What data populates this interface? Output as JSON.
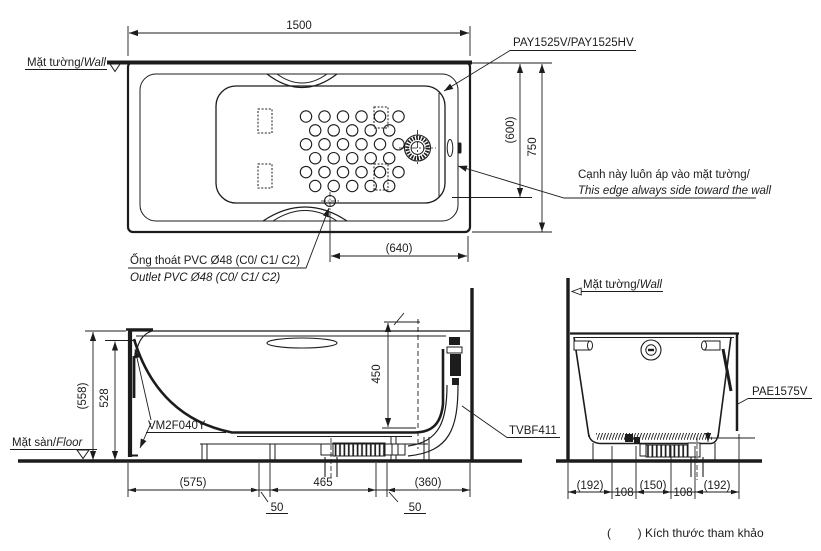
{
  "colors": {
    "ink": "#1c1c1c",
    "paper": "#ffffff"
  },
  "top_view": {
    "wall_label_vi": "Mặt tường/",
    "wall_label_en": "Wall",
    "dim_width": "1500",
    "model_label": "PAY1525V/PAY1525HV",
    "dim_inner": "(600)",
    "dim_overall": "750",
    "dim_outlet_offset": "(640)",
    "edge_note_vi": "Cạnh này luôn áp vào mặt tường/",
    "edge_note_en": "This edge always side toward the wall",
    "outlet_label_vi": "Ống thoát PVC Ø48 (C0/ C1/ C2)",
    "outlet_label_en": "Outlet PVC Ø48 (C0/ C1/ C2)"
  },
  "side_view": {
    "floor_label_vi": "Mặt sàn/",
    "floor_label_en": "Floor",
    "dim_height_overall": "(558)",
    "dim_height_rim": "528",
    "dim_depth": "450",
    "apron_part": "VM2F040Y",
    "drain_part": "TVBF411",
    "dims_bottom": [
      "(575)",
      "50",
      "465",
      "50",
      "(360)"
    ]
  },
  "end_view": {
    "wall_label_vi": "Mặt tường/",
    "wall_label_en": "Wall",
    "panel_part": "PAE1575V",
    "dims_bottom": [
      "(192)",
      "108",
      "(150)",
      "108",
      "(192)"
    ]
  },
  "footer": {
    "reference_note": "(        ) Kích thước tham khảo"
  }
}
